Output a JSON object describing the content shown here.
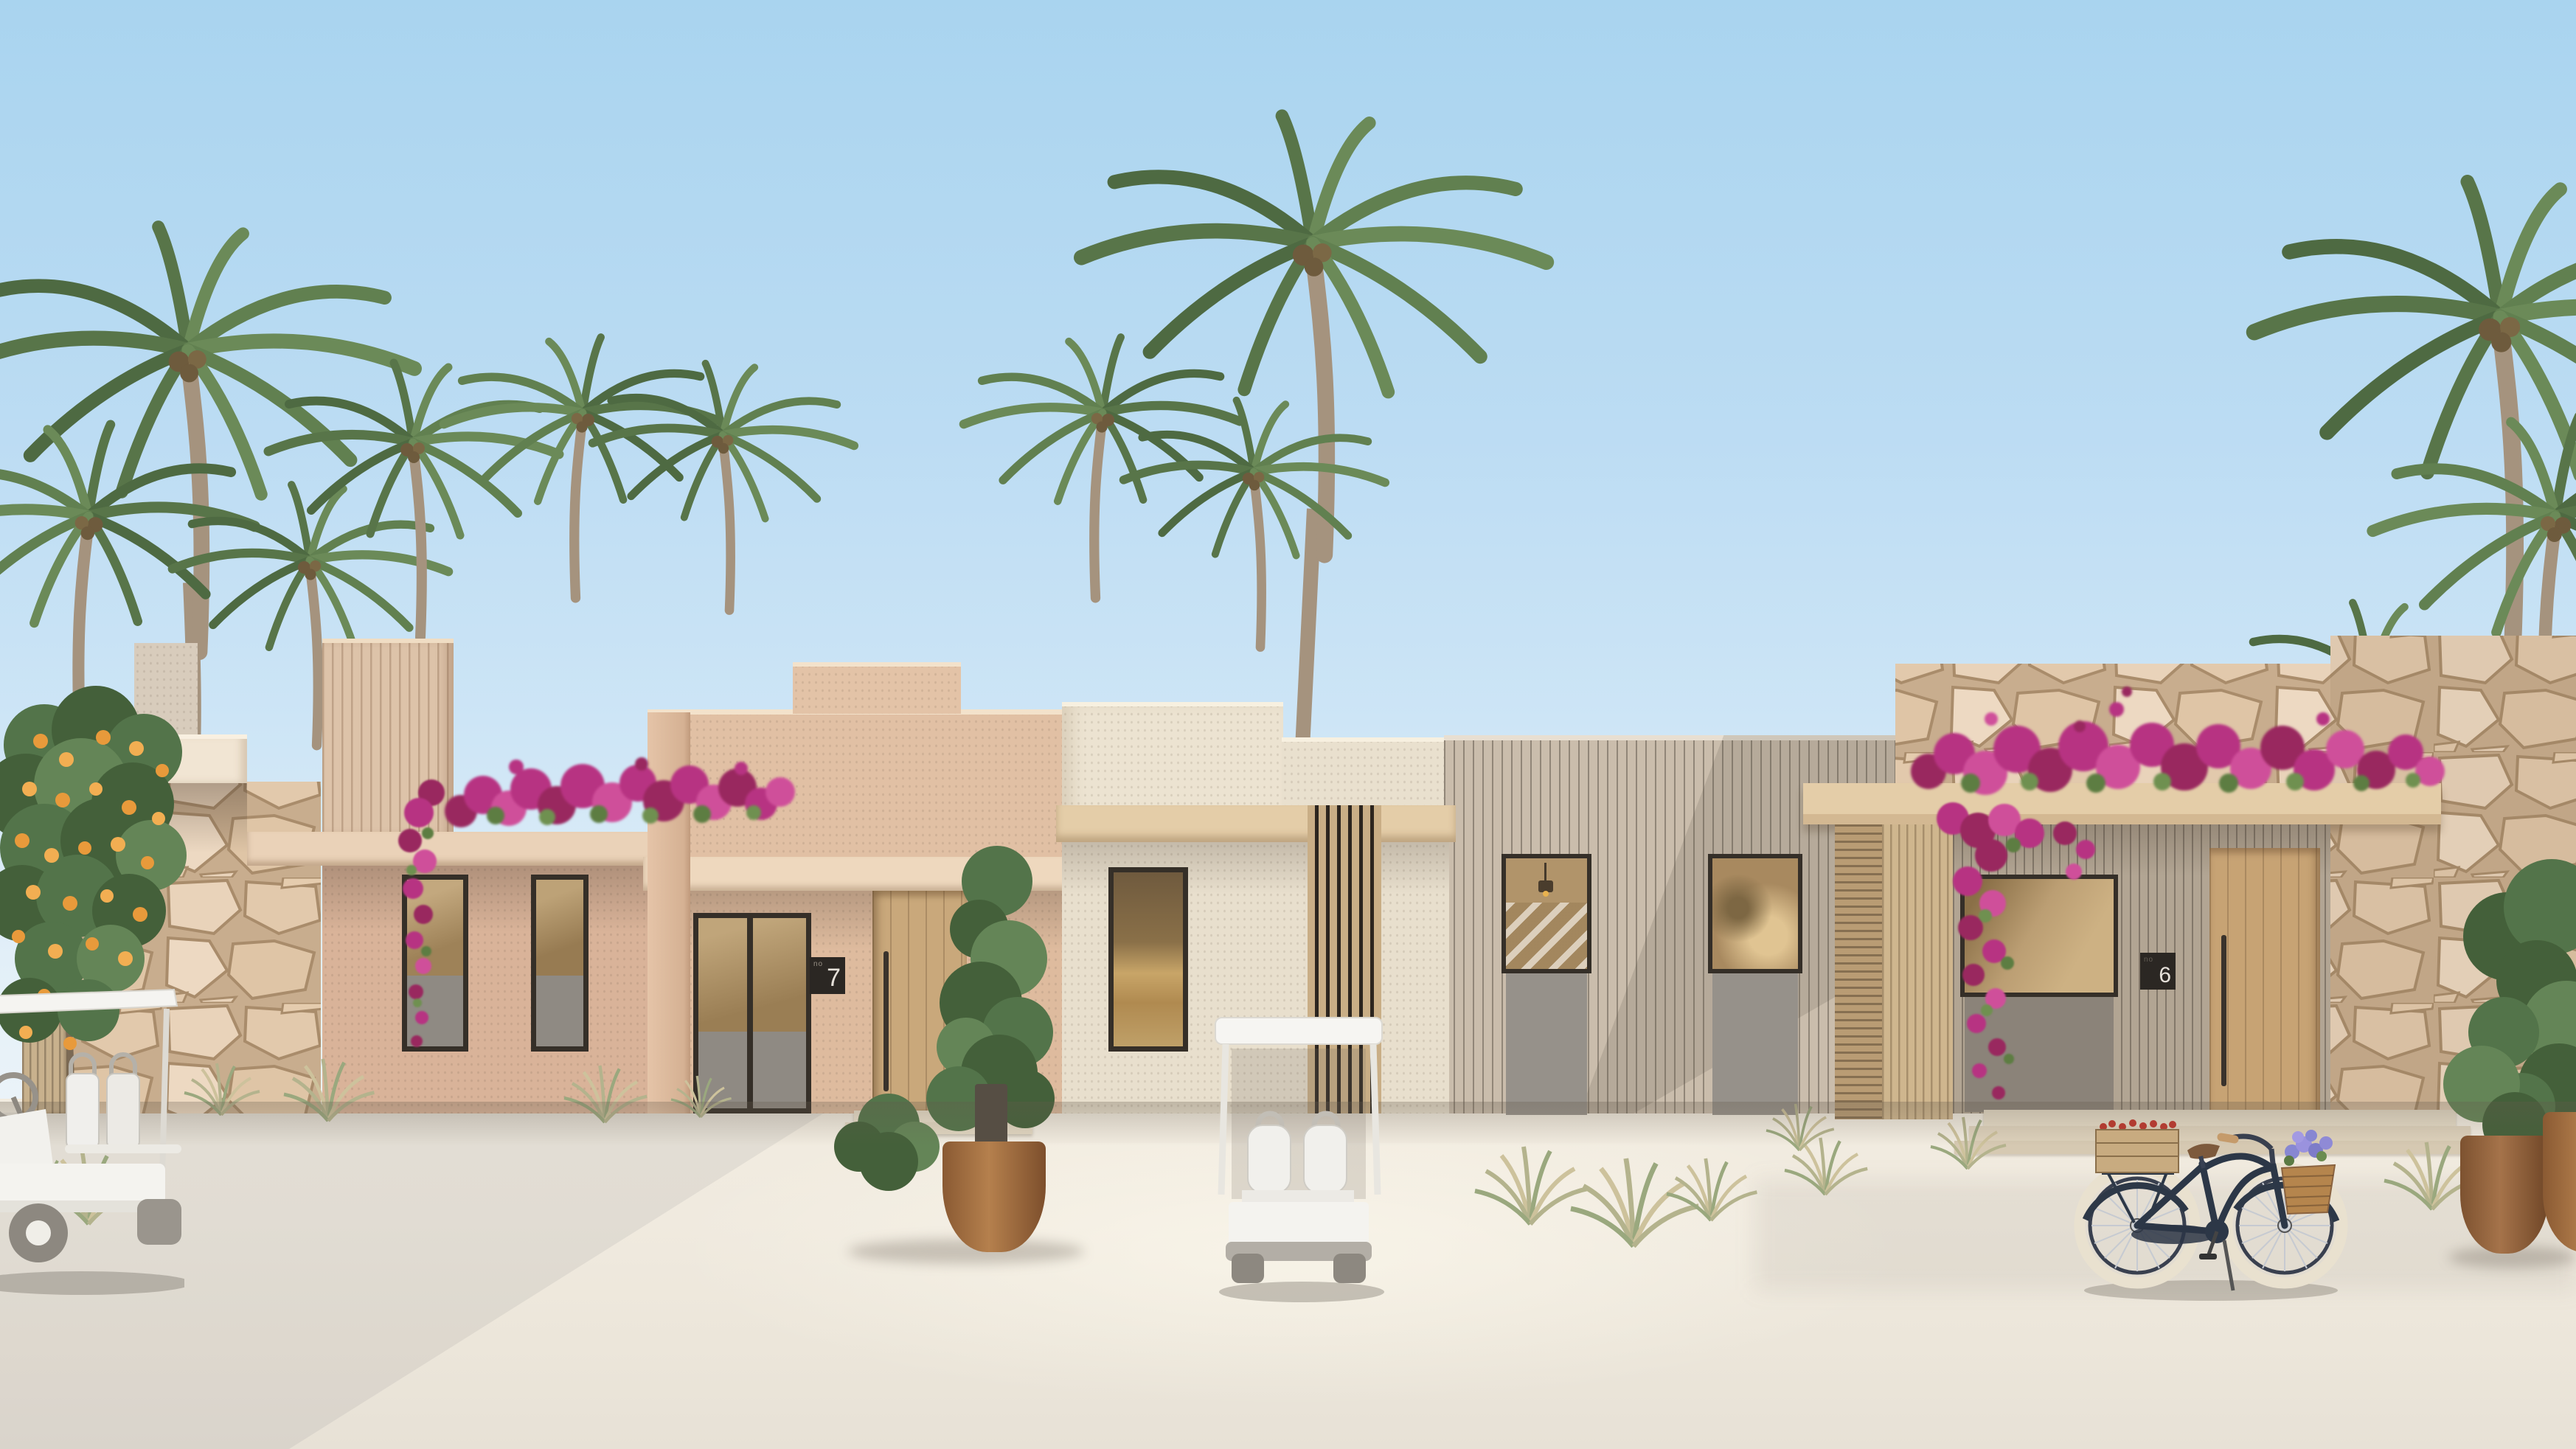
{
  "scene": {
    "type": "architectural-exterior-rendering",
    "setting": "row of single-storey beach resort villas on white sand with palm trees",
    "sky": "clear gradient blue sky",
    "ground": "white sand path"
  },
  "villas": [
    {
      "id": "villa-7",
      "plaque_prefix": "no",
      "plaque_number": "7",
      "facade": "sand-pink stucco, wood door, grey-panel windows, bougainvillea on parapet"
    },
    {
      "id": "villa-6",
      "plaque_prefix": "no",
      "plaque_number": "6",
      "facade": "taupe slatted cladding, wood door, pergola covered in bougainvillea, stone party walls"
    }
  ],
  "objects": {
    "palm_trees": "coconut palms behind and beside the villas",
    "orange_tree": "citrus tree with orange fruit at far left",
    "golf_cart_left": "white resort golf cart parked at far left",
    "golf_cart_center": "white golf cart parked in front of the cream villa",
    "bicycle": "navy cruiser bicycle with wicker flower basket and wooden crate in front of villa 6",
    "planters": "terracotta pots with clipped green shrubs",
    "bougainvillea": "magenta bougainvillea hedges on parapets and cascading vines",
    "stone_walls": "rubble limestone walls and pillars",
    "steps": "stone entry steps in front of villa 6 and villa 7"
  },
  "palette": {
    "sky-top": "#a9d4ef",
    "sky-mid": "#cfe6f6",
    "sky-horizon": "#eef5f9",
    "sand": "#f0eadf",
    "sand-shadow": "#dcd6cb",
    "cream-fascia": "#f1e5d3",
    "stucco-pink": "#d9b399",
    "stucco-tan": "#e1c0a4",
    "stucco-cream": "#ece3d1",
    "slat-taupe": "#cabdac",
    "slat-shade": "#b2a593",
    "wood-beam": "#e4cda8",
    "wood-door": "#c9a87b",
    "wood-screen": "#c9ae86",
    "stone-mortar": "#c8ad8e",
    "stone-fill": "#e9d3ba",
    "frame-dark": "#352f28",
    "glass-warm": "#b3966b",
    "panel-gray": "#8f8a83",
    "bougainvillea": "#b73382",
    "bougainvillea-dark": "#99285f",
    "leaf": "#587549",
    "leaf-dark": "#4e6a42",
    "leaf-light": "#6b8a58",
    "trunk": "#a5937e",
    "orange-fruit": "#e89a3b",
    "cart-white": "#f4f3ef",
    "cart-gray": "#8d8880",
    "bike-navy": "#2c3747",
    "bike-tire": "#e9e1cf",
    "terracotta": "#9c6a3c",
    "plaque-bg": "#2b2723",
    "plaque-text": "#e6e1da"
  }
}
